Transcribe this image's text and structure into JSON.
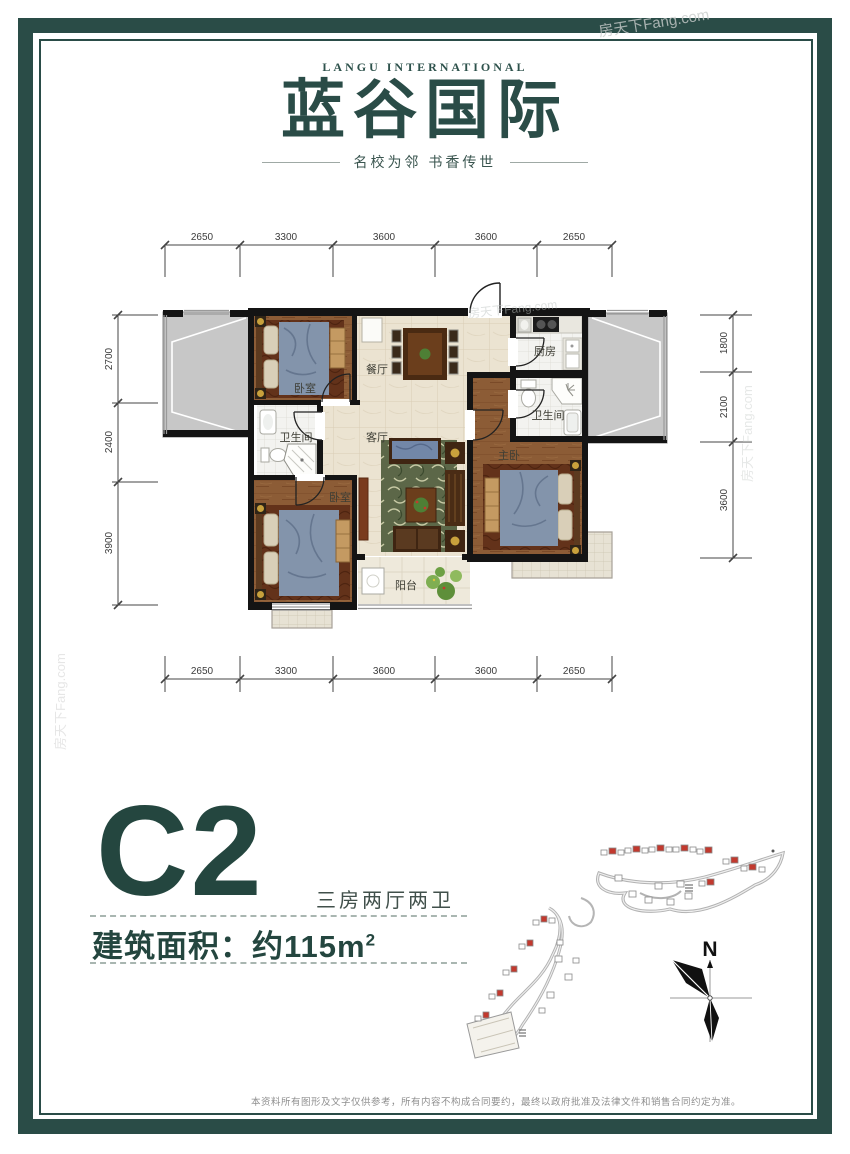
{
  "logo": {
    "en": "LANGU INTERNATIONAL",
    "cn": "蓝谷国际",
    "tagline": "名校为邻  书香传世"
  },
  "floor_plan": {
    "dims_top": [
      "2650",
      "3300",
      "3600",
      "3600",
      "2650"
    ],
    "dims_bottom": [
      "2650",
      "3300",
      "3600",
      "3600",
      "2650"
    ],
    "dims_left": [
      "2700",
      "2400",
      "3900"
    ],
    "dims_right": [
      "1800",
      "2100",
      "3600"
    ],
    "rooms": [
      {
        "id": "bedroom-1",
        "label": "卧室"
      },
      {
        "id": "dining-room",
        "label": "餐厅"
      },
      {
        "id": "kitchen",
        "label": "厨房"
      },
      {
        "id": "bathroom-master",
        "label": "卫生间"
      },
      {
        "id": "living-room",
        "label": "客厅"
      },
      {
        "id": "bathroom-2",
        "label": "卫生间"
      },
      {
        "id": "master-bedroom",
        "label": "主卧"
      },
      {
        "id": "bedroom-2",
        "label": "卧室"
      },
      {
        "id": "balcony",
        "label": "阳台"
      }
    ]
  },
  "unit": {
    "code": "C2",
    "layout_desc": "三房两厅两卫",
    "area_prefix": "建筑面积：约115m",
    "area_sup": "2"
  },
  "compass": {
    "north_label": "N"
  },
  "watermark": {
    "text": "房天下Fang.com"
  },
  "footer": {
    "disclaimer": "本资料所有图形及文字仅供参考，所有内容不构成合同要约，最终以政府批准及法律文件和销售合同约定为准。"
  },
  "colors": {
    "teal": "#2a4c47",
    "highlight_red": "#c2392e"
  }
}
